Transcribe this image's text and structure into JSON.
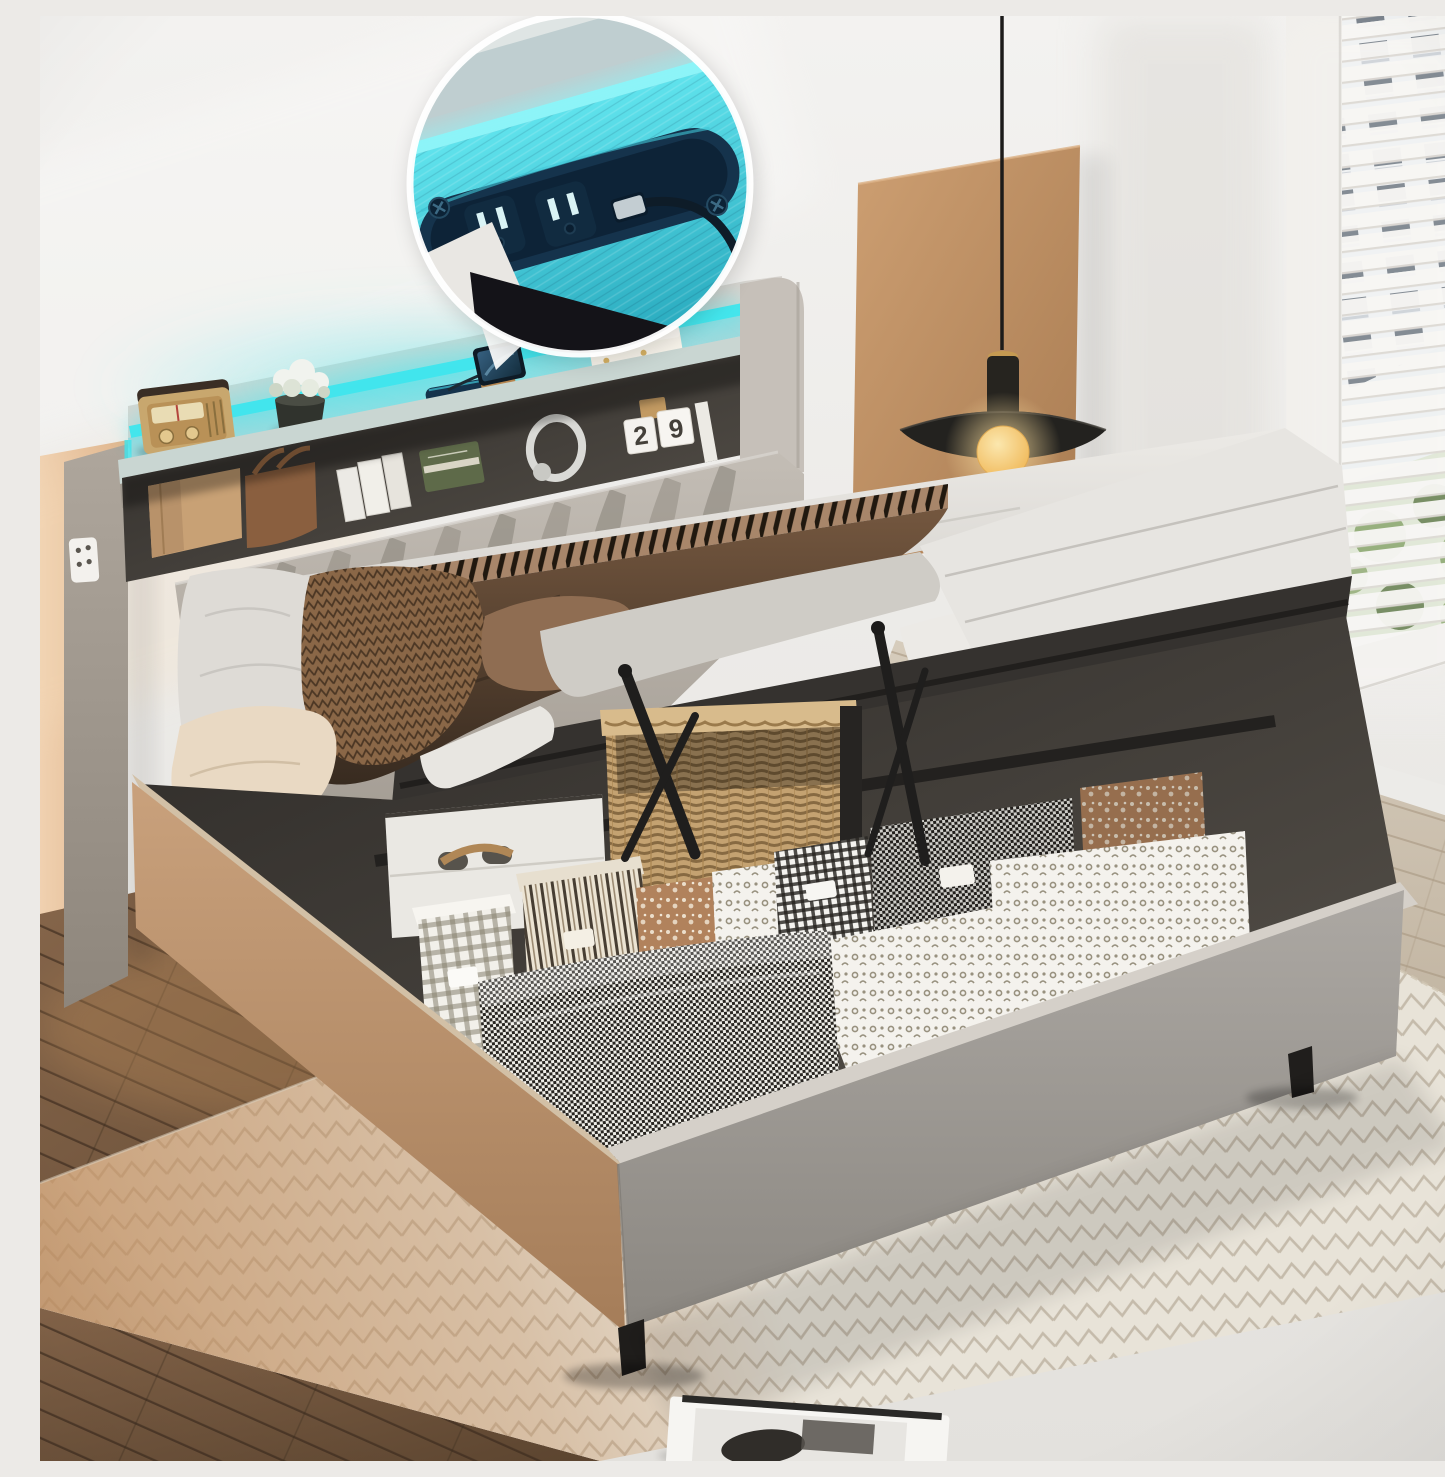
{
  "meta": {
    "type": "product-photograph",
    "description": "Grey upholstered queen storage bed with hydraulic lift-up mattress platform revealing under-bed storage filled with patterned fabric boxes, a wicker basket and a white suitcase; bookcase headboard with cyan LED lighting, charging station, vintage radio, plant, phone, tissue box and books; round inset callout showing built-in power strip with two AC outlets and a USB port; bedroom with pendant lamp, wood wall panel, window blinds and herringbone rug."
  },
  "callout": {
    "shape": "circle",
    "content": "close-up of headboard charging station: two AC outlets, USB port with cable, cyan LED light"
  },
  "calendar": {
    "digit_left": "2",
    "digit_right": "9"
  },
  "palette": {
    "wall": "#f0efec",
    "wallshade": "#e2e0dc",
    "peach": "#eccaa7",
    "panel": "#c8996c",
    "paneldark": "#aa7c52",
    "floorlight": "#cec3b2",
    "floordark": "#7c5f45",
    "rug": "#e8e3d8",
    "rugline": "#a79b87",
    "rugwarm": "#c08c5c",
    "fabric": "#b9b3ab",
    "fabricdark": "#9d968c",
    "fabriclight": "#d8d5d0",
    "led": "#3ee6ee",
    "leddeep": "#1fb9c9",
    "cushion": "#b6b0a8",
    "pleatshade": "#8d877e",
    "sheet": "#dedbd6",
    "duvet": "#cfccc6",
    "mattress": "#e7e5e1",
    "blanket": "#64503c",
    "blanketdark": "#3a2d21",
    "throw": "#8a6747",
    "pillowcream": "#e9d9c3",
    "pillowbrown": "#8f6d52",
    "basetan": "#c49d79",
    "basegrey": "#a5a19c",
    "interior": "#403c38",
    "metal": "#201e1c",
    "suitcase": "#eae8e3",
    "wicker": "#c4a271",
    "lamp": "#26241f",
    "lampgold": "#c59a52",
    "bulb": "#f6c96a",
    "bulbglow": "#f9dd9e",
    "stripnavy": "#15334c",
    "stripdark": "#0d2235",
    "slot": "#d9f3f5",
    "striprim": "#40c6d8",
    "blind": "#f6f5f2",
    "building": "#eef0f1",
    "buildingwin": "#5a6470",
    "leaf": "#7d9c5e",
    "ring": "#ffffff",
    "magazine": "#f6f5f2",
    "photodark": "#302d29",
    "bag": "#c8a175",
    "handbag": "#8a5f3f",
    "bookgreen": "#5e6a49",
    "bookwhite": "#eceae5",
    "radiogold": "#c8a76e",
    "radiodark": "#3a2e25",
    "pot": "#30332d",
    "flower": "#f1f3ee",
    "tissue": "#f7f3ea",
    "magenta_art": "#d98a8f",
    "outletplate": "#f3f1ed"
  }
}
